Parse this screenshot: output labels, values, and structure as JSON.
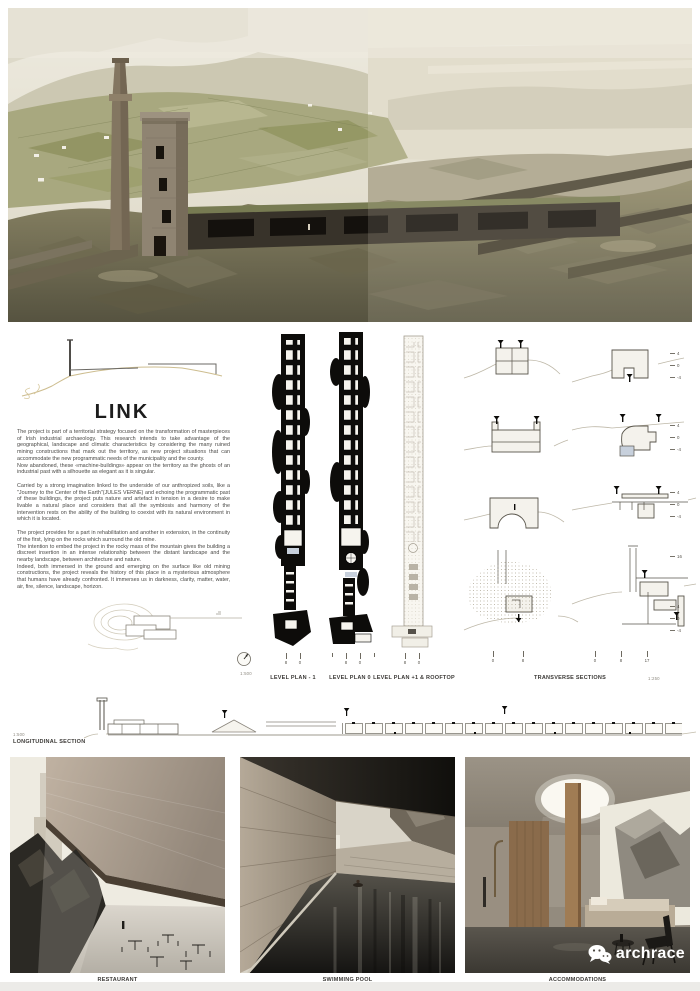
{
  "concept": {
    "title": "LINK"
  },
  "essay": {
    "p1": "The project is part of a territorial strategy focused on the transformation of masterpieces of Irish industrial archaeology. This research intends to take advantage of the geographical, landscape and climatic characteristics by considering the many ruined mining constructions that mark out the territory, as new project situations that can accommodate the new programmatic needs of the municipality and the county.\nNow abandoned, these «machine-buildings» appear on the territory as the ghosts of an industrial past with a silhouette as elegant as it is singular.",
    "p2": "Carried by a strong imagination linked to the underside of our anthropized soils, like a \"Journey to the Center of the Earth\"(JULES VERNE) and echoing the programmatic past of these buildings, the project puts nature and artefact in tension in a desire to make livable a natural place and considers that all the symbiosis and harmony of the intervention rests on the ability of the building to coexist with its natural environment in which it is located.",
    "p3": "The project provides for a part in rehabilitation and another in extension, in the continuity of the first, lying on the rocks which surround  the old mine.\nThe intention to embed the project in the rocky mass of the mountain gives the building a discreet insertion in an intense relationship between the distant landscape and the nearby landscape, between architecture and nature.\nIndeed, both immersed in the ground and emerging on the surface like old mining constructions, the project reveals the history of this place in a mysterious atmosphere that humans have already confronted. It immerses us in darkness, clarity, matter, water, air, fire, silence, landscape, horizon."
  },
  "plans": {
    "compass_scale": "1:500",
    "items": [
      {
        "label": "LEVEL PLAN - 1",
        "ticks": [
          "8",
          "0"
        ]
      },
      {
        "label": "LEVEL PLAN 0",
        "ticks": [
          "8",
          "0"
        ]
      },
      {
        "label": "LEVEL PLAN +1 & ROOFTOP",
        "ticks": [
          "8",
          "0"
        ]
      }
    ]
  },
  "transverse": {
    "label": "TRANSVERSE SECTIONS",
    "scale": "1:250",
    "bar1": [
      "0",
      "8"
    ],
    "bar2": [
      "0",
      "8",
      "17"
    ],
    "marks": [
      "4",
      "0",
      "-4",
      "4",
      "0",
      "-4",
      "4",
      "0",
      "-4",
      "16",
      "4",
      "0",
      "-4"
    ]
  },
  "longitudinal": {
    "label": "LONGITUDINAL SECTION",
    "scale": "1:500"
  },
  "renders": [
    {
      "label": "RESTAURANT"
    },
    {
      "label": "SWIMMING POOL"
    },
    {
      "label": "ACCOMMODATIONS"
    }
  ],
  "logo": {
    "text": "archrace",
    "icon": "wechat-icon"
  },
  "colors": {
    "paper": "#ffffff",
    "ink": "#3b3936",
    "sketch_tan": "#cdbd8f",
    "poche_black": "#0d0c0a",
    "terrain_line": "#beb8a8",
    "pool_blue": "#c7d0dc"
  }
}
